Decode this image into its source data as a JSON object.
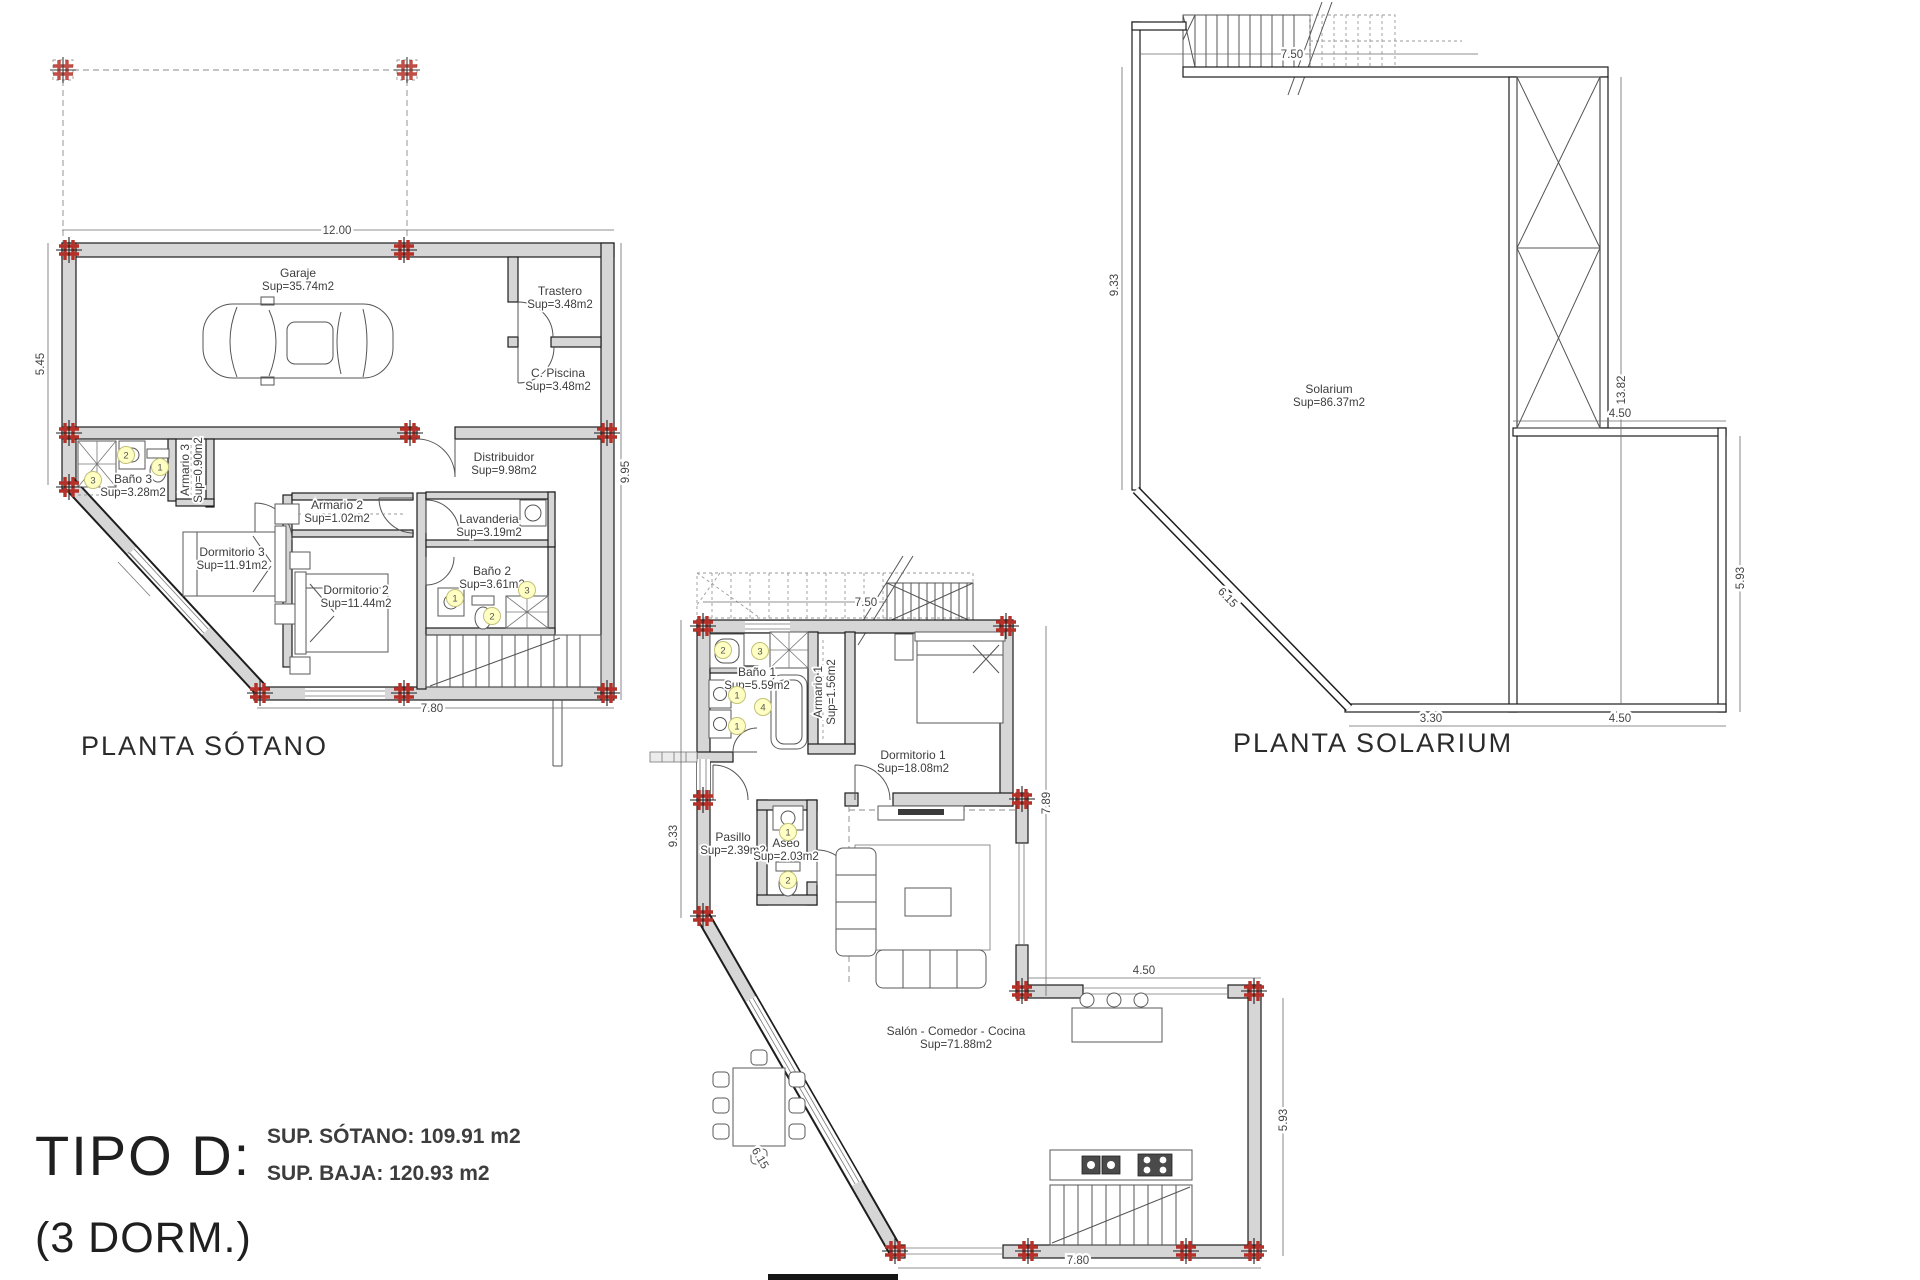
{
  "title_block": {
    "type_label": "TIPO D:",
    "dorm_label": "(3 DORM.)",
    "sup_sotano": "SUP. SÓTANO: 109.91 m2",
    "sup_baja": "SUP. BAJA: 120.93 m2"
  },
  "plans": {
    "sotano": {
      "label": "PLANTA SÓTANO",
      "rooms": [
        {
          "name": "Garaje",
          "sup": "Sup=35.74m2"
        },
        {
          "name": "Trastero",
          "sup": "Sup=3.48m2"
        },
        {
          "name": "C. Piscina",
          "sup": "Sup=3.48m2"
        },
        {
          "name": "Distribuidor",
          "sup": "Sup=9.98m2"
        },
        {
          "name": "Baño 3",
          "sup": "Sup=3.28m2"
        },
        {
          "name": "Armario 3",
          "sup": "Sup=0.90m2"
        },
        {
          "name": "Armario 2",
          "sup": "Sup=1.02m2"
        },
        {
          "name": "Lavanderia",
          "sup": "Sup=3.19m2"
        },
        {
          "name": "Dormitorio 3",
          "sup": "Sup=11.91m2"
        },
        {
          "name": "Dormitorio 2",
          "sup": "Sup=11.44m2"
        },
        {
          "name": "Baño 2",
          "sup": "Sup=3.61m2"
        }
      ],
      "dims": {
        "top": "12.00",
        "left": "5.45",
        "right": "9.95",
        "bottom": "7.80"
      },
      "badges": {
        "bath3": [
          "2",
          "1",
          "3"
        ],
        "bath2": [
          "1",
          "2",
          "3"
        ]
      }
    },
    "baja": {
      "rooms": [
        {
          "name": "Baño 1",
          "sup": "Sup=5.59m2"
        },
        {
          "name": "Armario 1",
          "sup": "Sup=1.56m2"
        },
        {
          "name": "Dormitorio 1",
          "sup": "Sup=18.08m2"
        },
        {
          "name": "Pasillo",
          "sup": "Sup=2.39m2"
        },
        {
          "name": "Aseo",
          "sup": "Sup=2.03m2"
        },
        {
          "name": "Salón - Comedor - Cocina",
          "sup": "Sup=71.88m2"
        }
      ],
      "dims": {
        "top": "7.50",
        "left": "9.33",
        "right_upper": "7.89",
        "projection": "4.50",
        "right_lower": "5.93",
        "chamfer": "6.15",
        "bottom": "7.80"
      },
      "badges": {
        "bath1": [
          "2",
          "3",
          "1",
          "1",
          "4"
        ],
        "aseo": [
          "1",
          "2"
        ]
      }
    },
    "solarium": {
      "label": "PLANTA SOLARIUM",
      "rooms": [
        {
          "name": "Solarium",
          "sup": "Sup=86.37m2"
        }
      ],
      "dims": {
        "top": "7.50",
        "left": "9.33",
        "column": "13.82",
        "terrace_top": "4.50",
        "right": "5.93",
        "chamfer": "6.15",
        "bottom_left": "3.30",
        "bottom_right": "4.50"
      }
    }
  }
}
